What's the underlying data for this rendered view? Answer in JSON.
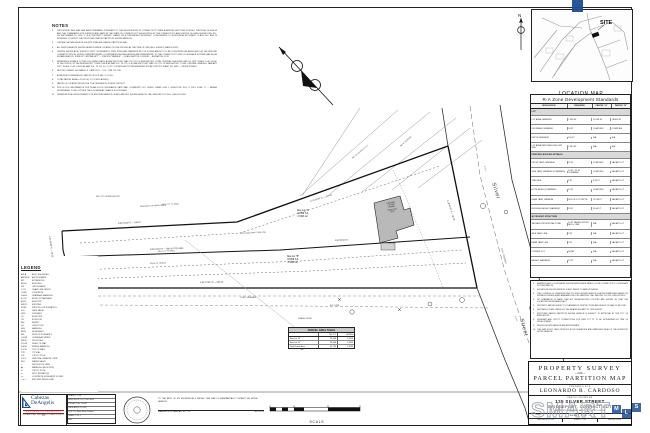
{
  "notes_panel": {
    "title": "NOTES",
    "items": [
      {
        "n": "1.",
        "t": "THIS SURVEY AND MAP HAS BEEN PREPARED PURSUANT TO THE REGULATIONS OF CONNECTICUT STATE AGENCIES SECTIONS 20-300b-1 THROUGH 20-300b-20 AND THE \"STANDARDS FOR SURVEYS AND MAPS IN THE STATE OF CONNECTICUT\" AS ADOPTED BY THE CONNECTICUT ASSOCIATION OF LAND SURVEYORS, INC. ON SEPTEMBER 26, 1996. IT IS A \"PROPERTY SURVEY\" BASED ON A \"DEPENDENT RESURVEY\" CONFORMING TO HORIZONTAL ACCURACY CLASS \"A-2\" AND IS INTENDED TO DEPICT THE PROPOSED PARCEL PARTITION SHOWN HEREON."
      },
      {
        "n": "2.",
        "t": "THE MAP SHOWN HEREON IS A SITE PLAN AND PARCEL PARTITION MAP."
      },
      {
        "n": "3.",
        "t": "ALL IMPROVEMENTS SHOWN HEREON WERE LOCATED ON THE GROUND AT THE TIME OF THE FIELD SURVEY (MARCH 2022)."
      },
      {
        "n": "4.",
        "t": "UNLESS SHOWN AS A \"SURVEY POINT\", MONUMENTS, PINS, PIPES AND MARKERS SET OR FOUND ARE NOT TO BE CONSTRUED AS BEING HELD AT THE PRECISE CORNER POSITION. NORTH ORIENTATION AND COORDINATES SHOWN HEREON ARE REFERENCED TO THE CONNECTICUT GRID COORDINATE SYSTEM (NAD 83) AS ESTABLISHED BY: STATION \"CENTRAL BPT\" — STATION \"SEASIDE\" — SCALE FACTOR: 0.999948 — ELEVATION: 11.42."
      },
      {
        "n": "5.",
        "t": "REFERENCE IS MADE TO THE FOLLOWING MAPS: A) MAP ENTITLED \"MAP OF CITY OF BRIDGEPORT, CONN. CENTRAL CHECKING, MAY 18, 1916\" SCALE 1\"=40', FILED IN THE OFFICE OF THE BRIDGEPORT TOWN CLERK AS MAP VOL. 18, PG. 8.  B) MAP ENTITLED \"MAP OF CITY OF BRIDGEPORT, CONN. CENTRAL GRADING, JANUARY 1917\" SCALE 1\"=40', FILED AS MAP VOL. 19, PG. 44.  C) CITY OF BRIDGEPORT ENGINEERING STREET LAYOUT SHEET NO. 4483 — SILVER STREET."
      },
      {
        "n": "6.",
        "t": "RECORD OWNER: LEONARDO R. CARDOSO — VOL. 7588, PG. 248."
      },
      {
        "n": "7.",
        "t": "ASSESSOR'S REFERENCE: MAP 86 / BLOCK 884 / LOT 016."
      },
      {
        "n": "8.",
        "t": "TOTAL PARCEL AREA = 41,525 SQ. FT. (0.9533 ACRES)."
      },
      {
        "n": "9.",
        "t": "PARCEL IS LOCATED WITHIN THE \"R-A\" RESIDENCE ZONING DISTRICT."
      },
      {
        "n": "10.",
        "t": "SITE FLOOD INFORMATION PER FEMA FLOOD INSURANCE RATE MAP, COMMUNITY NO. 090002, PANEL 0429 J, EFFECTIVE JULY 8, 2013: ZONE \"X\" — AREAS DETERMINED TO BE OUTSIDE THE 0.2% ANNUAL CHANCE FLOODPLAIN."
      },
      {
        "n": "11.",
        "t": "UNDERGROUND IMPROVEMENTS OR ENCROACHMENTS, IF ANY, ARE NOT SHOWN HEREON. CALL BEFORE YOU DIG: 1-800-922-4455."
      }
    ]
  },
  "legend": {
    "title": "LEGEND",
    "rows": [
      {
        "a": "A.K.A.",
        "t": "ALSO KNOWN AS"
      },
      {
        "a": "APPROX.",
        "t": "APPROXIMATE"
      },
      {
        "a": "BIT.",
        "t": "BITUMINOUS"
      },
      {
        "a": "BLDG.",
        "t": "BUILDING"
      },
      {
        "a": "CB",
        "t": "CATCH BASIN"
      },
      {
        "a": "C.L.F.",
        "t": "CHAIN LINK FENCE"
      },
      {
        "a": "CONC.",
        "t": "CONCRETE"
      },
      {
        "a": "D.M.H.",
        "t": "DRAINAGE MANHOLE"
      },
      {
        "a": "E.O.P.",
        "t": "EDGE OF PAVEMENT"
      },
      {
        "a": "ELEC.",
        "t": "ELECTRIC"
      },
      {
        "a": "EXIST.",
        "t": "EXISTING"
      },
      {
        "a": "F.F.EL.",
        "t": "FIRST FLOOR ELEVATION"
      },
      {
        "a": "G.V.",
        "t": "GATE VALVE"
      },
      {
        "a": "HYD.",
        "t": "HYDRANT"
      },
      {
        "a": "I.P.",
        "t": "IRON PIPE"
      },
      {
        "a": "I.R.",
        "t": "IRON ROD"
      },
      {
        "a": "INV.",
        "t": "INVERT"
      },
      {
        "a": "L.P.",
        "t": "LIGHT POLE"
      },
      {
        "a": "M.H.",
        "t": "MANHOLE"
      },
      {
        "a": "MON.",
        "t": "MONUMENT"
      },
      {
        "a": "N/F",
        "t": "NOW OR FORMERLY"
      },
      {
        "a": "O.H.W.",
        "t": "OVERHEAD WIRES"
      },
      {
        "a": "PROP.",
        "t": "PROPOSED"
      },
      {
        "a": "R.O.W.",
        "t": "RIGHT OF WAY"
      },
      {
        "a": "S.M.H.",
        "t": "SEWER MANHOLE"
      },
      {
        "a": "T.O.W.",
        "t": "TOP OF WALL"
      },
      {
        "a": "TYP.",
        "t": "TYPICAL"
      },
      {
        "a": "U.P.",
        "t": "UTILITY POLE"
      },
      {
        "a": "V.G.C.",
        "t": "VERTICAL GRANITE CURB"
      },
      {
        "a": "W.V.",
        "t": "WATER VALVE"
      },
      {
        "a": "○",
        "t": "DECIDUOUS TREE"
      },
      {
        "a": "◉",
        "t": "MANHOLE (AS NOTED)"
      },
      {
        "a": "⊙",
        "t": "UTILITY POLE"
      },
      {
        "a": "✕",
        "t": "SPOT ELEVATION"
      },
      {
        "a": "▭",
        "t": "CONCRETE MONUMENT FOUND"
      },
      {
        "a": "—x—",
        "t": "EXISTING FENCE LINE"
      }
    ]
  },
  "location_map": {
    "title": "LOCATION MAP",
    "scale": "SCALE: 1\" = 1000'",
    "site": "SITE",
    "north": "N"
  },
  "zone_table": {
    "title": "R-A Zone Development Standards",
    "headers": [
      "REGULATION",
      "REQUIRED",
      "PARCEL \"A\"",
      "PARCEL \"B\""
    ],
    "rows": [
      {
        "cls": "sec",
        "c1": "LOT",
        "c2": "",
        "c3": "",
        "c4": ""
      },
      {
        "c1": "LOT AREA, MINIMUM",
        "c2": "7,500 SF",
        "c3": "22,656 SF",
        "c4": "18,869 SF"
      },
      {
        "c1": "FRONTAGE, MINIMUM",
        "c2": "50 FT",
        "c3": "COMPLIES",
        "c4": "COMPLIES"
      },
      {
        "c1": "DEPTH, MINIMUM",
        "c2": "100 FT",
        "c3": "N/A",
        "c4": "N/A"
      },
      {
        "c1": "LOT AREA PER DWELLING UNIT, MIN.",
        "c2": "7,500 SF",
        "c3": "N/A",
        "c4": "N/A"
      },
      {
        "cls": "sec",
        "c1": "PRINCIPAL BUILDING SETBACK",
        "c2": "",
        "c3": "",
        "c4": ""
      },
      {
        "c1": "FRONT YARD, MINIMUM",
        "c2": "25 FT",
        "c3": "COMPLIES",
        "c4": "VACANT LOT"
      },
      {
        "c1": "SIDE YARD, MINIMUM (COMBINED)",
        "c2": "10 FT / 25 FT COMBINED",
        "c3": "COMPLIES",
        "c4": "VACANT LOT"
      },
      {
        "c1": "ONE SIDE",
        "c2": "6 FT",
        "c3": "6.28 FT",
        "c4": "VACANT LOT"
      },
      {
        "c1": "BOTH SIDES (COMBINED)",
        "c2": "16 FT",
        "c3": "COMPLIES",
        "c4": "VACANT LOT"
      },
      {
        "c1": "REAR YARD, MINIMUM",
        "c2": "30% OF LOT DEPTH",
        "c3": "125.46 FT",
        "c4": "VACANT LOT"
      },
      {
        "c1": "BUILDING HEIGHT, MAXIMUM",
        "c2": "35 FT",
        "c3": "26.40 FT",
        "c4": "VACANT LOT"
      },
      {
        "cls": "sec",
        "c1": "ACCESSORY STRUCTURE",
        "c2": "",
        "c3": "",
        "c4": ""
      },
      {
        "c1": "SETBACK FROM STREET LINE",
        "c2": "10 FT BEHIND FRONT BLDG. LINE",
        "c3": "N/A",
        "c4": "VACANT LOT"
      },
      {
        "c1": "SIDE YARD LINE",
        "c2": "3 FT",
        "c3": "N/A",
        "c4": "VACANT LOT"
      },
      {
        "c1": "REAR YARD LINE",
        "c2": "3 FT",
        "c3": "N/A",
        "c4": "VACANT LOT"
      },
      {
        "c1": "CORNER LOT",
        "c2": "NONE",
        "c3": "N/A",
        "c4": "VACANT LOT"
      },
      {
        "c1": "HEIGHT, MAXIMUM",
        "c2": "15 FT",
        "c3": "N/A",
        "c4": "VACANT LOT"
      }
    ]
  },
  "site_notes": {
    "items": [
      {
        "n": "1.",
        "t": "BEARINGS AND COORDINATES SHOWN HEREON ARE BASED ON THE CONNECTICUT COORDINATE SYSTEM (NAD 83)."
      },
      {
        "n": "2.",
        "t": "ELEVATIONS SHOWN HEREON, IF ANY, REFER TO NAVD 88 DATUM."
      },
      {
        "n": "3.",
        "t": "THE LOCATION OF UNDERGROUND UTILITIES SHOWN HEREON IS APPROXIMATE AND BASED ON SURFACE EVIDENCE AND AVAILABLE RECORD MAPPING. CALL BEFORE YOU DIG 1-800-922-4455."
      },
      {
        "n": "4.",
        "t": "NO GUARANTEE IS MADE THAT ALL UNDERGROUND UTILITIES ARE SHOWN OR THAT THE LOCATIONS SHOWN ARE EXACT."
      },
      {
        "n": "5.",
        "t": "PROPERTY MAY BE SUBJECT TO EASEMENTS, RESTRICTIONS AND RIGHTS OF WAY OF RECORD."
      },
      {
        "n": "6.",
        "t": "WETLANDS, IF ANY, WERE NOT DELINEATED AS PART OF THIS SURVEY."
      },
      {
        "n": "7.",
        "t": "PROPOSED PARCEL PARTITION SHOWN HEREON IS SUBJECT TO APPROVAL BY THE CITY OF BRIDGEPORT."
      },
      {
        "n": "8.",
        "t": "DRIVEWAY AND UTILITY CONNECTIONS FOR NEW LOT \"B\" TO BE DETERMINED AT TIME OF DEVELOPMENT."
      },
      {
        "n": "9.",
        "t": "FENCES SHOWN HEREON ARE APPROXIMATE."
      },
      {
        "n": "10.",
        "t": "THIS MAP IS NOT VALID WITHOUT A LIVE SIGNATURE AND EMBOSSED SEAL OF THE SURVEYOR NOTED HEREON."
      }
    ]
  },
  "area_table": {
    "title": "PARCEL AREA TABLE",
    "col_label": "",
    "col_sqft": "SQ. FT.",
    "col_acres": "ACRES",
    "rows": [
      {
        "l": "New Lot \"A\"",
        "sf": "22,656",
        "ac": "0.5201"
      },
      {
        "l": "New Lot \"B\"",
        "sf": "18,869",
        "ac": "0.4332"
      },
      {
        "l": "Total Parcel Area",
        "sf": "41,525",
        "ac": "0.9533"
      }
    ]
  },
  "title_block": {
    "line1": "PROPERTY SURVEY",
    "and": "— AND —",
    "line2": "PARCEL PARTITION MAP",
    "prepared_for": "PREPARED FOR",
    "client": "LEONARDO R. CARDOSO",
    "known_as": "PARCEL KNOWN AS",
    "address": "125 SILVER STREET",
    "city": "BRIDGEPORT, CONNECTICUT",
    "reference": "ASSESSOR'S REFERENCE: MAP 86 / BLOCK 884 / LOT 016",
    "sheet": "SHEET 1 OF 1",
    "strip": [
      "DATE: APRIL 21, 2022",
      "SCALE: 1\" = 20'",
      "DWG No. 22-045"
    ]
  },
  "firm": {
    "name1": "Cabezas",
    "name2": "DeAngelis",
    "tagline": "ENGINEERS & SURVEYORS",
    "address": "3156 MAIN STREET • BRIDGEPORT, CT 06606 • P (203) 371-1793",
    "fields": [
      "SCALE: 1\" = 20'",
      "FIELD BOOK: 173 / PGS. 46-52",
      "PROJECT No.: 22-045",
      "DATE: APRIL 21, 2022",
      "FILE: 125 Silver Street Partition",
      "SHEET: 1 OF 1",
      "REV:"
    ]
  },
  "certification": {
    "text": "TO THE BEST OF MY KNOWLEDGE & BELIEF, THIS MAP IS SUBSTANTIALLY CORRECT AS NOTED HEREON.",
    "name": "WASHINGTON CABEZAS, JR., L.S.",
    "license": "No. 70576"
  },
  "scale_bar": {
    "label": "SCALE"
  },
  "watermark": {
    "text": "SMART",
    "squares": [
      {
        "t": "M",
        "cls": "s1"
      },
      {
        "t": "L",
        "cls": "s2"
      },
      {
        "t": "S",
        "cls": "s3"
      }
    ],
    "blue": "#1d4e8f"
  },
  "drawing": {
    "lot_a": {
      "lines": [
        "New Lot \"A\"",
        "22,656 S.F.",
        "0.5201 Ac."
      ]
    },
    "lot_b": {
      "lines": [
        "New Lot \"B\"",
        "18,869 S.F.",
        "0.4332 Ac."
      ]
    },
    "building": {
      "lines": [
        "EXISTING",
        "2 STORY",
        "FRAME",
        "DWELLING",
        "#125"
      ]
    },
    "labels": [
      {
        "cls": "st",
        "x": 496,
        "y": 182,
        "rot": 73,
        "t": "Silver"
      },
      {
        "cls": "st",
        "x": 524,
        "y": 318,
        "rot": 75,
        "t": "Street"
      },
      {
        "cls": "b",
        "x": 118,
        "y": 223,
        "rot": -3,
        "t": "N 82°04'10\" E — 248.12'"
      },
      {
        "cls": "b",
        "x": 310,
        "y": 201,
        "rot": -17,
        "t": "N 71°18'35\" E — 214.60'"
      },
      {
        "cls": "b",
        "x": 150,
        "y": 249,
        "rot": -2,
        "t": "N 82°04'10\" E — 585.00' (TIE LINE)"
      },
      {
        "cls": "b",
        "x": 335,
        "y": 240,
        "rot": -2,
        "t": "N 80°55'20\" E"
      },
      {
        "cls": "b",
        "x": 200,
        "y": 282,
        "rot": -1,
        "t": "S 82°13'30\" W — 583.00'"
      },
      {
        "cls": "b",
        "x": 448,
        "y": 200,
        "rot": 72,
        "t": "S 29°41'20\" E — 96.00'"
      },
      {
        "cls": "b",
        "x": 50,
        "y": 236,
        "rot": 82,
        "t": "S 07°55'40\" E — 26.00'"
      },
      {
        "cls": "m",
        "x": 96,
        "y": 196,
        "rot": 0,
        "t": "N/F CITY OF BRIDGEPORT"
      },
      {
        "cls": "m",
        "x": 140,
        "y": 206,
        "rot": -3,
        "t": "REMNANTS OF WIRE FENCE"
      },
      {
        "cls": "m",
        "x": 240,
        "y": 233,
        "rot": -3,
        "t": "PROPOSED PARTITION LINE"
      },
      {
        "cls": "m",
        "x": 150,
        "y": 263,
        "rot": -2,
        "t": "EDGE OF GRAVEL"
      },
      {
        "cls": "m",
        "x": 240,
        "y": 297,
        "rot": 0,
        "t": "CONC. SIDEWALK"
      },
      {
        "cls": "m",
        "x": 330,
        "y": 305,
        "rot": 0,
        "t": "BIT. CURB"
      },
      {
        "cls": "m",
        "x": 485,
        "y": 166,
        "rot": 72,
        "t": "V.G.C."
      },
      {
        "cls": "m",
        "x": 502,
        "y": 248,
        "rot": 74,
        "t": "CONC. SIDEWALK"
      },
      {
        "cls": "m",
        "x": 516,
        "y": 316,
        "rot": 75,
        "t": "E.O.P."
      },
      {
        "cls": "m",
        "x": 352,
        "y": 158,
        "rot": -40,
        "t": "N/F 115 SILVER ST LLC"
      },
      {
        "cls": "m",
        "x": 400,
        "y": 146,
        "rot": -42,
        "t": "N/F M. PEREIRA"
      },
      {
        "cls": "m",
        "x": 298,
        "y": 318,
        "rot": 0,
        "t": "GRAVEL DRIVE"
      },
      {
        "cls": "m",
        "x": 162,
        "y": 204,
        "rot": -2,
        "t": "MIN. LOT \"A\" AREA"
      },
      {
        "cls": "m",
        "x": 158,
        "y": 251,
        "rot": -2,
        "t": "MIN. LOT \"B\" AREA"
      }
    ]
  }
}
